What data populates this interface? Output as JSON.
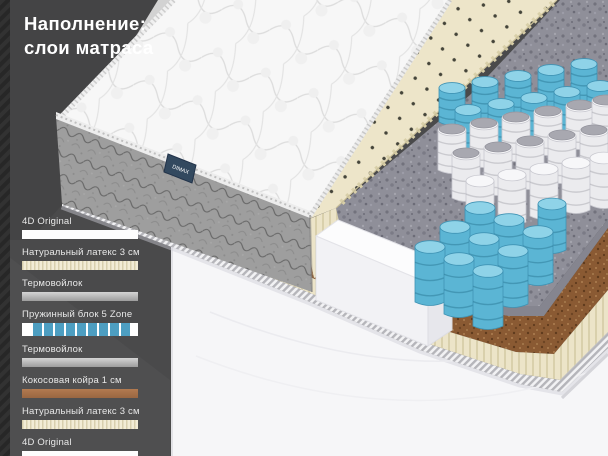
{
  "title": {
    "line1": "Наполнение:",
    "line2": "слои матраса"
  },
  "brand_tag": "DIMAX",
  "legend": [
    {
      "label": "4D Original",
      "swatch": "white"
    },
    {
      "label": "Натуральный латекс 3 см",
      "swatch": "latex"
    },
    {
      "label": "Термовойлок",
      "swatch": "felt"
    },
    {
      "label": "Пружинный блок 5 Zone",
      "swatch": "springs"
    },
    {
      "label": "Термовойлок",
      "swatch": "felt"
    },
    {
      "label": "Кокосовая койра 1 см",
      "swatch": "coir"
    },
    {
      "label": "Натуральный латекс 3 см",
      "swatch": "latex"
    },
    {
      "label": "4D Original",
      "swatch": "white"
    }
  ],
  "colors": {
    "background": "#4a4a4b",
    "accent_blue": "#4d9ec1",
    "latex_cream": "#ece4c8",
    "felt_gray": "#8f8f99",
    "coir_brown": "#8a5a33",
    "swatch_white": "#fdfdfd"
  }
}
